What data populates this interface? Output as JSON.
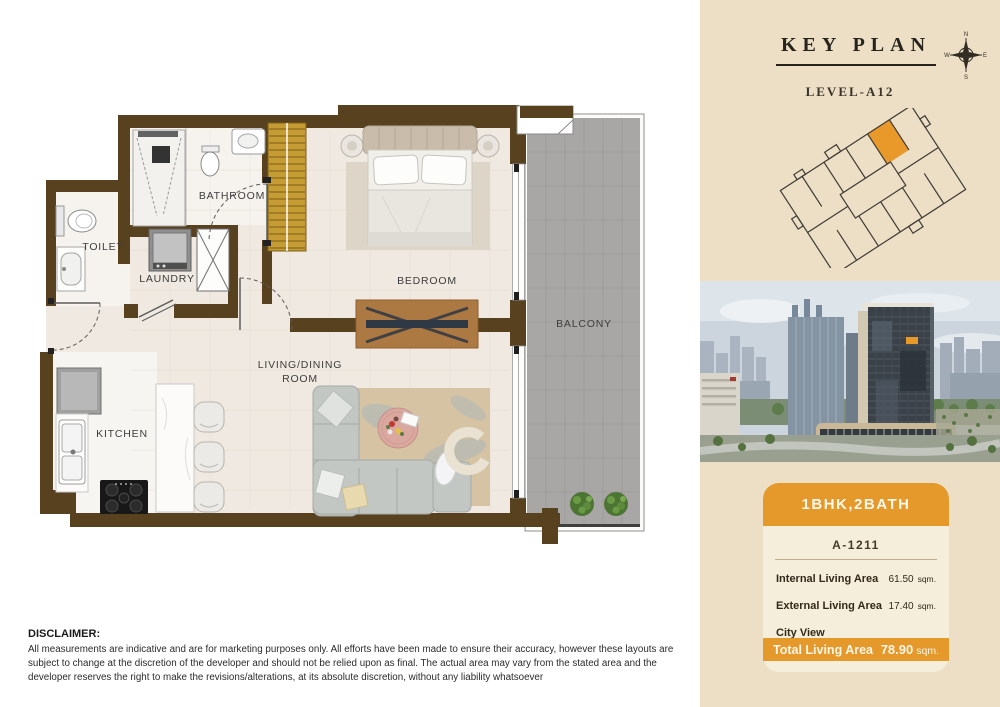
{
  "floor_plan": {
    "rooms": {
      "bathroom": "BATHROOM",
      "toilet": "TOILET",
      "laundry": "LAUNDRY",
      "bedroom": "BEDROOM",
      "balcony": "BALCONY",
      "living_line1": "LIVING/DINING",
      "living_line2": "ROOM",
      "kitchen": "KITCHEN"
    },
    "wall_color": "#57411f"
  },
  "key_plan": {
    "title": "KEY PLAN",
    "level": "LEVEL-A12",
    "compass": {
      "north": "N",
      "east": "E",
      "south": "S",
      "west": "W"
    },
    "highlight_color": "#e8992a"
  },
  "unit_card": {
    "type_label": "1BHK,2BATH",
    "unit_number": "A-1211",
    "accent_color": "#e5992b",
    "details": [
      {
        "label": "Internal Living Area",
        "value": "61.50",
        "unit": "sqm."
      },
      {
        "label": "External Living Area",
        "value": "17.40",
        "unit": "sqm."
      },
      {
        "label": "City View",
        "value": "",
        "unit": ""
      }
    ],
    "total": {
      "label": "Total Living Area",
      "value": "78.90",
      "unit": "sqm."
    }
  },
  "disclaimer": {
    "heading": "DISCLAIMER:",
    "body": "All measurements are indicative and are for marketing purposes only. All efforts have been made to ensure their accuracy, however these layouts are subject to change at the discretion of the developer and should not be relied upon as final. The actual area may vary from the stated area and the developer reserves the right to make the revisions/alterations, at its absolute discretion, without any liability whatsoever"
  }
}
